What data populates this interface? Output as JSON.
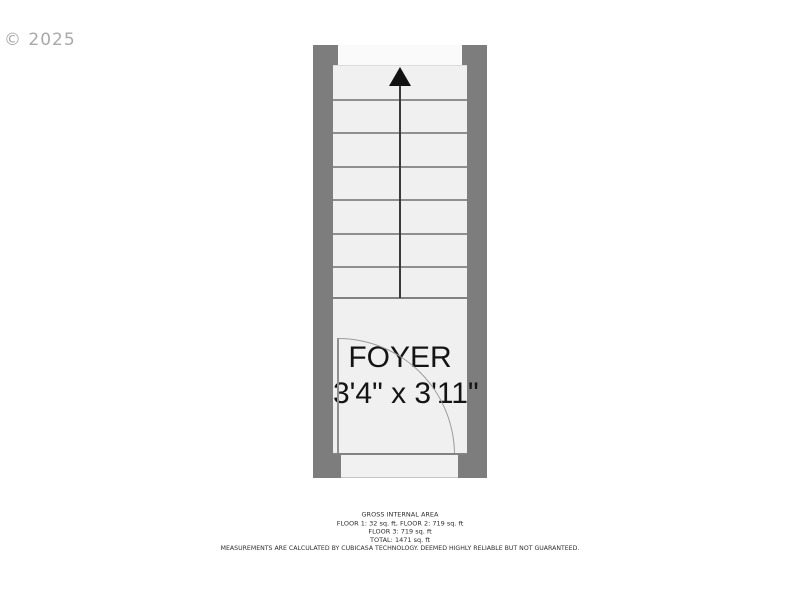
{
  "watermark": {
    "text": "© 2025"
  },
  "floor_plan": {
    "room": {
      "label": "FOYER",
      "dimensions": "3'4\" x 3'11\""
    },
    "stairs": {
      "direction": "up",
      "arrow_icon": "up-arrow",
      "tread_count": 7
    },
    "door": {
      "type": "swing",
      "arc": "quarter-circle"
    }
  },
  "footer": {
    "title": "GROSS INTERNAL AREA",
    "floors_line_1": "FLOOR 1: 32 sq. ft, FLOOR 2: 719 sq. ft",
    "floors_line_2": "FLOOR 3: 719 sq. ft",
    "total": "TOTAL: 1471 sq. ft",
    "disclaimer": "MEASUREMENTS ARE CALCULATED BY CUBICASA TECHNOLOGY. DEEMED HIGHLY RELIABLE BUT NOT GUARANTEED."
  },
  "colors": {
    "wall": "#7d7d7d",
    "floor": "#f0f0f0",
    "landing": "#fafafa",
    "tread_line": "#8f8f8f",
    "stair_line": "#3a3a3a",
    "arrow": "#121212",
    "arc": "#9c9c9c",
    "edge": "#828282",
    "room_text": "#141414",
    "watermark": "#a9a9a9",
    "footer_text": "#2e2e2e"
  }
}
